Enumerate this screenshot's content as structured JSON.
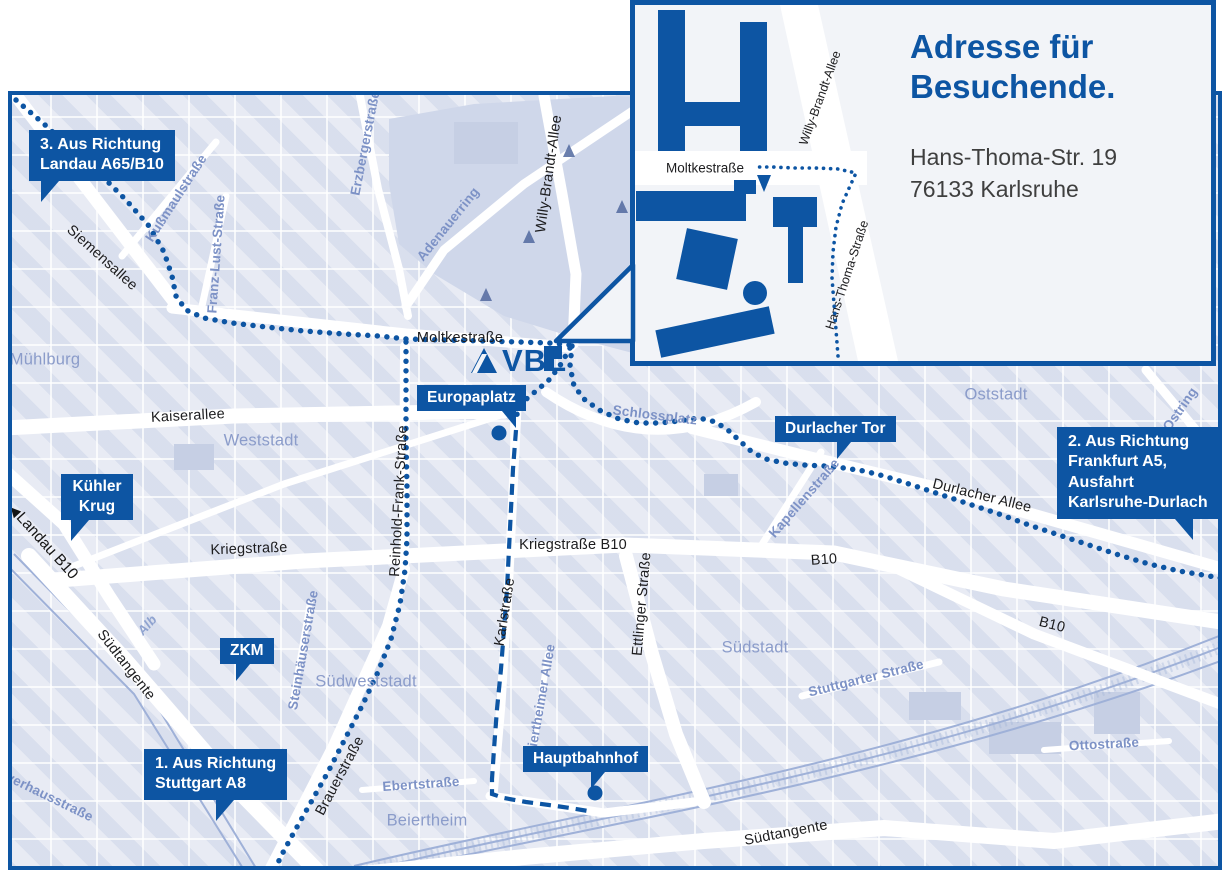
{
  "colors": {
    "brand_blue": "#0d55a3",
    "map_background": "#e8ebf4",
    "district_label": "#8b9cca",
    "minor_street_label": "#7d92c6",
    "street_label": "#1c1c1e",
    "address_text": "#3f3f3f"
  },
  "logo": {
    "text": "VBL"
  },
  "inset": {
    "heading": [
      "Adresse für",
      "Besuchende."
    ],
    "address": [
      "Hans-Thoma-Str. 19",
      "76133 Karlsruhe"
    ],
    "labels": {
      "moltkestrasse": "Moltkestraße",
      "willy_brandt_allee": "Willy-Brandt-Allee",
      "hans_thoma_strasse": "Hans-Thoma-Straße"
    }
  },
  "callouts": {
    "landau": {
      "lines": [
        "3. Aus Richtung",
        "Landau A65/B10"
      ]
    },
    "frankfurt": {
      "lines": [
        "2. Aus Richtung",
        "Frankfurt A5,",
        "Ausfahrt",
        "Karlsruhe-Durlach"
      ]
    },
    "stuttgart": {
      "lines": [
        "1. Aus Richtung",
        "Stuttgart A8"
      ]
    },
    "kuehler_krug": {
      "lines": [
        "Kühler",
        "Krug"
      ]
    },
    "zkm": {
      "lines": [
        "ZKM"
      ]
    },
    "europaplatz": {
      "lines": [
        "Europaplatz"
      ]
    },
    "durlacher_tor": {
      "lines": [
        "Durlacher Tor"
      ]
    },
    "hauptbahnhof": {
      "lines": [
        "Hauptbahnhof"
      ]
    }
  },
  "map": {
    "direction_marker": {
      "arrow": "◀",
      "text": "Landau B10"
    },
    "labels": [
      {
        "t": "Siemensallee",
        "x": 98,
        "y": 254,
        "r": 42,
        "c": "k"
      },
      {
        "t": "Moltkestraße",
        "x": 456,
        "y": 334,
        "r": 0,
        "c": "k"
      },
      {
        "t": "Kaiserallee",
        "x": 184,
        "y": 412,
        "r": -3,
        "c": "k"
      },
      {
        "t": "Kriegstraße",
        "x": 245,
        "y": 545,
        "r": -2,
        "c": "k"
      },
      {
        "t": "Kriegstraße B10",
        "x": 569,
        "y": 541,
        "r": 0,
        "c": "k"
      },
      {
        "t": "Reinhold-Frank-Straße",
        "x": 395,
        "y": 497,
        "r": -87,
        "c": "k"
      },
      {
        "t": "Karlstraße",
        "x": 501,
        "y": 608,
        "r": -81,
        "c": "k"
      },
      {
        "t": "Ettlinger Straße",
        "x": 638,
        "y": 600,
        "r": -85,
        "c": "k"
      },
      {
        "t": "Durlacher Allee",
        "x": 978,
        "y": 492,
        "r": 14,
        "c": "k"
      },
      {
        "t": "B10",
        "x": 820,
        "y": 556,
        "r": -4,
        "c": "k"
      },
      {
        "t": "B10",
        "x": 1048,
        "y": 621,
        "r": 14,
        "c": "k"
      },
      {
        "t": "Südtangente",
        "x": 122,
        "y": 661,
        "r": 52,
        "c": "k"
      },
      {
        "t": "Südtangente",
        "x": 782,
        "y": 829,
        "r": -11,
        "c": "k"
      },
      {
        "t": "Brauerstraße",
        "x": 336,
        "y": 772,
        "r": -62,
        "c": "k"
      },
      {
        "t": "Willy-Brandt-Allee",
        "x": 545,
        "y": 170,
        "r": -82,
        "c": "k"
      },
      {
        "t": "Kußmaulstraße",
        "x": 172,
        "y": 194,
        "r": -57,
        "c": "b"
      },
      {
        "t": "Franz-Lust-Straße",
        "x": 212,
        "y": 250,
        "r": -86,
        "c": "b"
      },
      {
        "t": "Erzbergerstraße",
        "x": 361,
        "y": 139,
        "r": -79,
        "c": "b"
      },
      {
        "t": "Adenauerring",
        "x": 444,
        "y": 220,
        "r": -51,
        "c": "b"
      },
      {
        "t": "Kapellenstraße",
        "x": 800,
        "y": 494,
        "r": -49,
        "c": "b"
      },
      {
        "t": "Schlossplatz",
        "x": 651,
        "y": 411,
        "r": 7,
        "c": "b"
      },
      {
        "t": "Steinhäuserstraße",
        "x": 299,
        "y": 646,
        "r": -80,
        "c": "b"
      },
      {
        "t": "Ebertstraße",
        "x": 417,
        "y": 780,
        "r": -4,
        "c": "b"
      },
      {
        "t": "Beiertheimer Allee",
        "x": 536,
        "y": 700,
        "r": -80,
        "c": "b"
      },
      {
        "t": "Ostring",
        "x": 1176,
        "y": 405,
        "r": -55,
        "c": "b"
      },
      {
        "t": "Ostring",
        "x": 1189,
        "y": 498,
        "r": -55,
        "c": "b"
      },
      {
        "t": "Ottostraße",
        "x": 1100,
        "y": 740,
        "r": -3,
        "c": "b"
      },
      {
        "t": "Stuttgarter Straße",
        "x": 862,
        "y": 674,
        "r": -14,
        "c": "b"
      },
      {
        "t": "Pulverhausstraße",
        "x": 36,
        "y": 788,
        "r": 26,
        "c": "b"
      },
      {
        "t": "Alb",
        "x": 143,
        "y": 621,
        "r": -48,
        "c": "w"
      },
      {
        "t": "Mühlburg",
        "x": 41,
        "y": 356,
        "r": 0,
        "c": "d"
      },
      {
        "t": "Weststadt",
        "x": 257,
        "y": 437,
        "r": 0,
        "c": "d"
      },
      {
        "t": "Südweststadt",
        "x": 362,
        "y": 678,
        "r": 0,
        "c": "d"
      },
      {
        "t": "Südstadt",
        "x": 751,
        "y": 644,
        "r": 0,
        "c": "d"
      },
      {
        "t": "Oststadt",
        "x": 992,
        "y": 391,
        "r": 0,
        "c": "d"
      },
      {
        "t": "Beiertheim",
        "x": 423,
        "y": 817,
        "r": 0,
        "c": "d"
      }
    ]
  },
  "routes": [
    {
      "id": "landau-moltkestrasse",
      "type": "dots",
      "layer": "map",
      "points": [
        [
          12,
          96
        ],
        [
          40,
          120
        ],
        [
          68,
          146
        ],
        [
          96,
          170
        ],
        [
          122,
          196
        ],
        [
          145,
          222
        ],
        [
          160,
          248
        ],
        [
          168,
          272
        ],
        [
          172,
          292
        ],
        [
          182,
          306
        ],
        [
          200,
          314
        ],
        [
          228,
          319
        ],
        [
          262,
          323
        ],
        [
          300,
          327
        ],
        [
          340,
          330
        ],
        [
          375,
          332
        ],
        [
          402,
          335
        ],
        [
          440,
          336
        ],
        [
          480,
          337
        ],
        [
          515,
          338
        ],
        [
          545,
          339
        ],
        [
          566,
          341
        ]
      ]
    },
    {
      "id": "reinhold-frank-brauerstrasse",
      "type": "dots",
      "layer": "map",
      "points": [
        [
          402,
          338
        ],
        [
          402,
          385
        ],
        [
          402,
          435
        ],
        [
          403,
          485
        ],
        [
          403,
          535
        ],
        [
          401,
          566
        ],
        [
          396,
          600
        ],
        [
          387,
          635
        ],
        [
          374,
          668
        ],
        [
          359,
          700
        ],
        [
          342,
          733
        ],
        [
          324,
          768
        ],
        [
          306,
          800
        ],
        [
          289,
          830
        ],
        [
          276,
          854
        ],
        [
          269,
          872
        ]
      ]
    },
    {
      "id": "schlossplatz-durlacher-allee",
      "type": "dots",
      "layer": "map",
      "points": [
        [
          568,
          342
        ],
        [
          566,
          362
        ],
        [
          570,
          382
        ],
        [
          581,
          396
        ],
        [
          597,
          407
        ],
        [
          615,
          415
        ],
        [
          635,
          419
        ],
        [
          655,
          419
        ],
        [
          675,
          417
        ],
        [
          695,
          414
        ],
        [
          712,
          418
        ],
        [
          725,
          427
        ],
        [
          737,
          438
        ],
        [
          748,
          448
        ],
        [
          762,
          455
        ],
        [
          780,
          459
        ],
        [
          800,
          461
        ],
        [
          820,
          462
        ],
        [
          840,
          464
        ],
        [
          860,
          467
        ],
        [
          880,
          472
        ],
        [
          905,
          480
        ],
        [
          935,
          490
        ],
        [
          965,
          500
        ],
        [
          995,
          510
        ],
        [
          1025,
          521
        ],
        [
          1055,
          531
        ],
        [
          1085,
          541
        ],
        [
          1115,
          551
        ],
        [
          1145,
          560
        ],
        [
          1175,
          567
        ],
        [
          1205,
          572
        ],
        [
          1228,
          576
        ]
      ]
    },
    {
      "id": "vbl-europaplatz",
      "type": "dots",
      "layer": "map",
      "points": [
        [
          566,
          344
        ],
        [
          557,
          360
        ],
        [
          546,
          375
        ],
        [
          532,
          387
        ],
        [
          520,
          397
        ],
        [
          513,
          407
        ],
        [
          513,
          417
        ]
      ]
    },
    {
      "id": "karlstrasse-hauptbahnhof",
      "type": "dash",
      "layer": "map",
      "points": [
        [
          512,
          426
        ],
        [
          509,
          465
        ],
        [
          507,
          505
        ],
        [
          505,
          545
        ],
        [
          503,
          585
        ],
        [
          500,
          625
        ],
        [
          497,
          665
        ],
        [
          493,
          705
        ],
        [
          490,
          745
        ],
        [
          488,
          775
        ],
        [
          488,
          790
        ],
        [
          500,
          794
        ],
        [
          522,
          798
        ],
        [
          545,
          801
        ],
        [
          566,
          804
        ],
        [
          584,
          807
        ]
      ]
    },
    {
      "id": "inset-hans-thoma-route",
      "type": "dots-sm",
      "layer": "overlay",
      "points": [
        [
          838,
          356
        ],
        [
          836,
          330
        ],
        [
          834,
          304
        ],
        [
          832,
          278
        ],
        [
          833,
          252
        ],
        [
          836,
          227
        ],
        [
          842,
          204
        ],
        [
          850,
          186
        ],
        [
          856,
          173
        ],
        [
          838,
          169
        ],
        [
          816,
          168
        ],
        [
          794,
          168
        ],
        [
          772,
          167
        ],
        [
          757,
          167
        ]
      ]
    }
  ],
  "markers": {
    "stations": [
      {
        "id": "europaplatz-stop",
        "x": 495,
        "y": 429
      },
      {
        "id": "hauptbahnhof-stop",
        "x": 591,
        "y": 789
      }
    ],
    "inset_entrance_arrow": [
      [
        757,
        175
      ],
      [
        771,
        175
      ],
      [
        764,
        192
      ]
    ]
  }
}
